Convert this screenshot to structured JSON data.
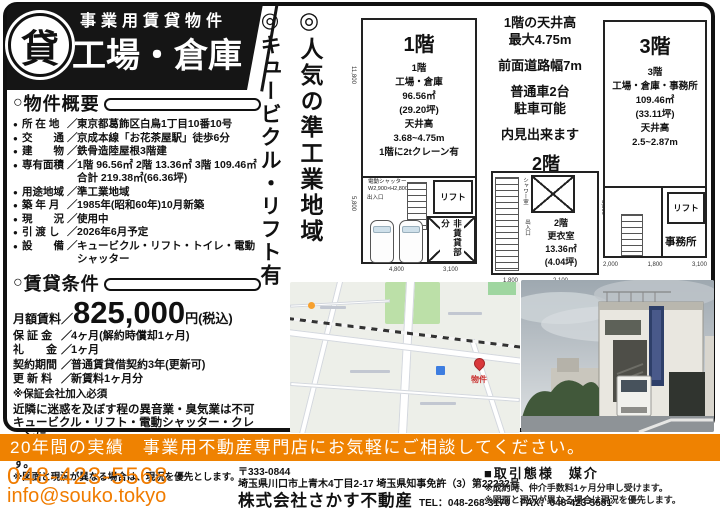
{
  "icons": {
    "bullet": "●",
    "circle": "○",
    "slash": "／"
  },
  "header": {
    "banner_top": "事業用賃貸物件",
    "logo_char": "貸",
    "title": "工場・倉庫"
  },
  "vertical_notes": {
    "left": "◎キュービクル・リフト有",
    "right": "◎人気の準工業地域"
  },
  "overview": {
    "heading": "物件概要",
    "items": [
      {
        "label": "所 在 地",
        "value": "東京都葛飾区白鳥1丁目10番10号"
      },
      {
        "label": "交　　通",
        "value": "京成本線「お花茶屋駅」徒歩6分"
      },
      {
        "label": "建　　物",
        "value": "鉄骨造陸屋根3階建"
      },
      {
        "label": "専有面積",
        "value": "1階 96.56㎡ 2階 13.36㎡ 3階 109.46㎡\n合計 219.38㎡(66.36坪)"
      },
      {
        "label": "用途地域",
        "value": "準工業地域"
      },
      {
        "label": "築 年 月",
        "value": "1985年(昭和60年)10月新築"
      },
      {
        "label": "現　　況",
        "value": "使用中"
      },
      {
        "label": "引 渡 し",
        "value": "2026年6月予定"
      },
      {
        "label": "設　　備",
        "value": "キュービクル・リフト・トイレ・電動シャッター"
      }
    ]
  },
  "rent": {
    "heading": "賃貸条件",
    "monthly_label": "月額賃料／",
    "monthly_amount": "825,000",
    "monthly_unit": "円(税込)",
    "items": [
      {
        "label": "保 証 金",
        "value": "4ヶ月(解約時償却1ヶ月)"
      },
      {
        "label": "礼　　金",
        "value": "1ヶ月"
      },
      {
        "label": "契約期間",
        "value": "普通賃貸借契約3年(更新可)"
      },
      {
        "label": "更 新 料",
        "value": "新賃料1ヶ月分"
      }
    ],
    "note1": "※保証会社加入必須",
    "warning": "近隣に迷惑を及ぼす程の異音業・臭気業は不可\nキュービクル・リフト・電動シャッター・クレーンに\n掛かるメンテナンス費用は借主負担となります。",
    "note2": "※図面と現況が異なる場合は、現況を優先とします。"
  },
  "center_info": {
    "blocks": [
      "1階の天井高\n最大4.75m",
      "前面道路幅7m",
      "普通車2台\n駐車可能",
      "内見出来ます"
    ]
  },
  "plans": {
    "f1": {
      "title": "1階",
      "info": "1階\n工場・倉庫\n96.56㎡\n(29.20坪)\n天井高\n3.68~4.75m\n1階に2tクレーン有",
      "shutter": "電動シャッター\nW2,900×H2,800",
      "entrance": "出入口",
      "lift": "リフト",
      "nonrent": "非賃貸部分",
      "dim_left_top": "11,800",
      "dim_left_bottom": "5,800",
      "dim_bottom_left": "4,800",
      "dim_bottom_right": "3,100"
    },
    "f2": {
      "title": "2階",
      "info": "2階\n更衣室\n13.36㎡\n(4.04坪)",
      "shower": "シャワー室",
      "entrance": "出入口",
      "dim_bottom_left": "1,800",
      "dim_bottom_right": "2,100",
      "dim_right": "5,800"
    },
    "f3": {
      "title": "3階",
      "info": "3階\n工場・倉庫・事務所\n109.46㎡\n(33.11坪)\n天井高\n2.5~2.87m",
      "lift": "リフト",
      "office": "事務所",
      "dims_bottom": [
        "2,000",
        "1,800",
        "3,100"
      ]
    }
  },
  "map": {
    "pin_label": "物件"
  },
  "footer_bar": "20年間の実績　事業用不動産専門店にお気軽にご相談してください。",
  "contact": {
    "phone": "048-423-5568",
    "email": "info@souko.tokyo",
    "postal": "〒333-0844",
    "address": "埼玉県川口市上青木4丁目2-17 埼玉県知事免許（3）第22232号",
    "company": "株式会社さかす不動産",
    "telfax": "TEL：048-268-3170　FAX：048-423-5581",
    "deal_type": "■取引態様　媒介",
    "deal_note1": "※成約時、仲介手数料1ヶ月分申し受けます。",
    "deal_note2": "※図面と現況が異なる場合は現況を優先します。"
  },
  "colors": {
    "accent_orange": "#ef8201",
    "pin_red": "#d9383b",
    "ink": "#111111"
  }
}
